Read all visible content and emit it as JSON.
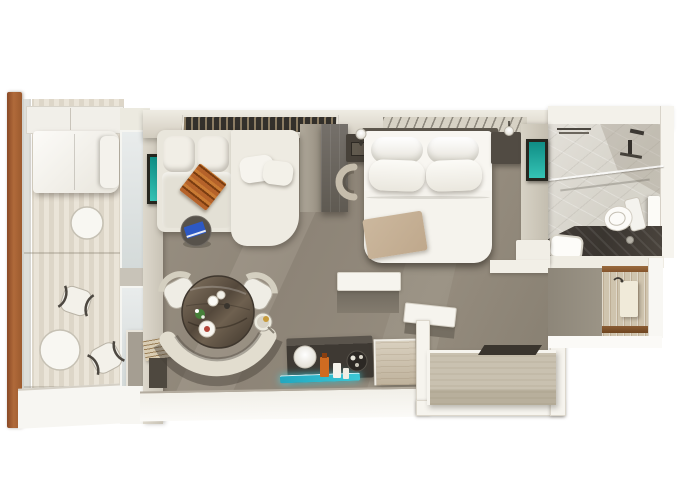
{
  "meta": {
    "type": "3d-floorplan-render",
    "subject": "top-down 3D floor plan of a cruise-ship balcony suite stateroom",
    "visible_text": "none"
  },
  "palette": {
    "canvas": "#ffffff",
    "carpet": "#8d8477",
    "carpet_light": "#9a9183",
    "wall_cream": "#d8d2c5",
    "wall_white": "#f6f4ee",
    "sofa": "#e9e6dc",
    "bed_linen": "#f5f3ed",
    "pillow": "#fcfbf7",
    "throw_beige": "#ccb89e",
    "throw_orange": "#b5622a",
    "accent_orange": "#d2691e",
    "accent_teal": "#1fa99d",
    "accent_cyan": "#3cc8d6",
    "accent_blue": "#2d59c4",
    "wood_post": "#b06a3a",
    "wood_table": "#65584a",
    "bench": "#e0dbcd",
    "deck": "#e7e1d5",
    "console_dark": "#3e3933",
    "divider_dark": "#5f5a52",
    "marble_floor": "#d6d3ca",
    "vanity_stone": "#3a3530",
    "corridor_wood": "#cfc4ae",
    "trim_brown": "#84542c",
    "wardrobe_top": "#c9c1b0"
  },
  "rooms": [
    {
      "name": "balcony",
      "items": [
        "privacy-divider",
        "lounger",
        "round-table-large",
        "cafe-chair-1",
        "round-table-small",
        "cafe-chair-2",
        "glass-railing",
        "wood-post",
        "sliding-glass-door"
      ]
    },
    {
      "name": "living-area",
      "items": [
        "l-shaped-sofa",
        "chaise-pillows",
        "striped-throw",
        "wall-art-teal",
        "round-side-table",
        "blue-book",
        "dining-table",
        "curved-banquette",
        "dining-chair-left",
        "dining-chair-right",
        "champagne-bucket",
        "table-setting",
        "media-console",
        "sphere-lamp",
        "decor-bottles",
        "serving-tray",
        "illuminated-teal-shelf",
        "wood-dresser",
        "magazine-stack",
        "ceiling-vent"
      ]
    },
    {
      "name": "bedroom",
      "items": [
        "double-bed",
        "pillows",
        "beige-foot-throw",
        "nightstand-left",
        "nightstand-right",
        "reading-lamp-left",
        "reading-lamp-right",
        "slatted-headboard-panel",
        "wardrobe-divider",
        "crescent-bench",
        "wall-art-teal-2"
      ]
    },
    {
      "name": "bathroom",
      "items": [
        "marble-floor",
        "walk-in-shower",
        "shower-fixtures",
        "towel-bar",
        "glass-screen",
        "toilet",
        "flush-panel",
        "stone-vanity-counter",
        "sink"
      ]
    },
    {
      "name": "entry-hall",
      "items": [
        "entry-door",
        "door-handle",
        "wood-plank-floor",
        "threshold-trim-top",
        "threshold-trim-bottom"
      ]
    },
    {
      "name": "closet-nook",
      "items": [
        "wardrobe-unit",
        "wardrobe-slot",
        "half-wall-ledge-left",
        "half-wall-ledge-right",
        "outer-wall"
      ]
    }
  ]
}
